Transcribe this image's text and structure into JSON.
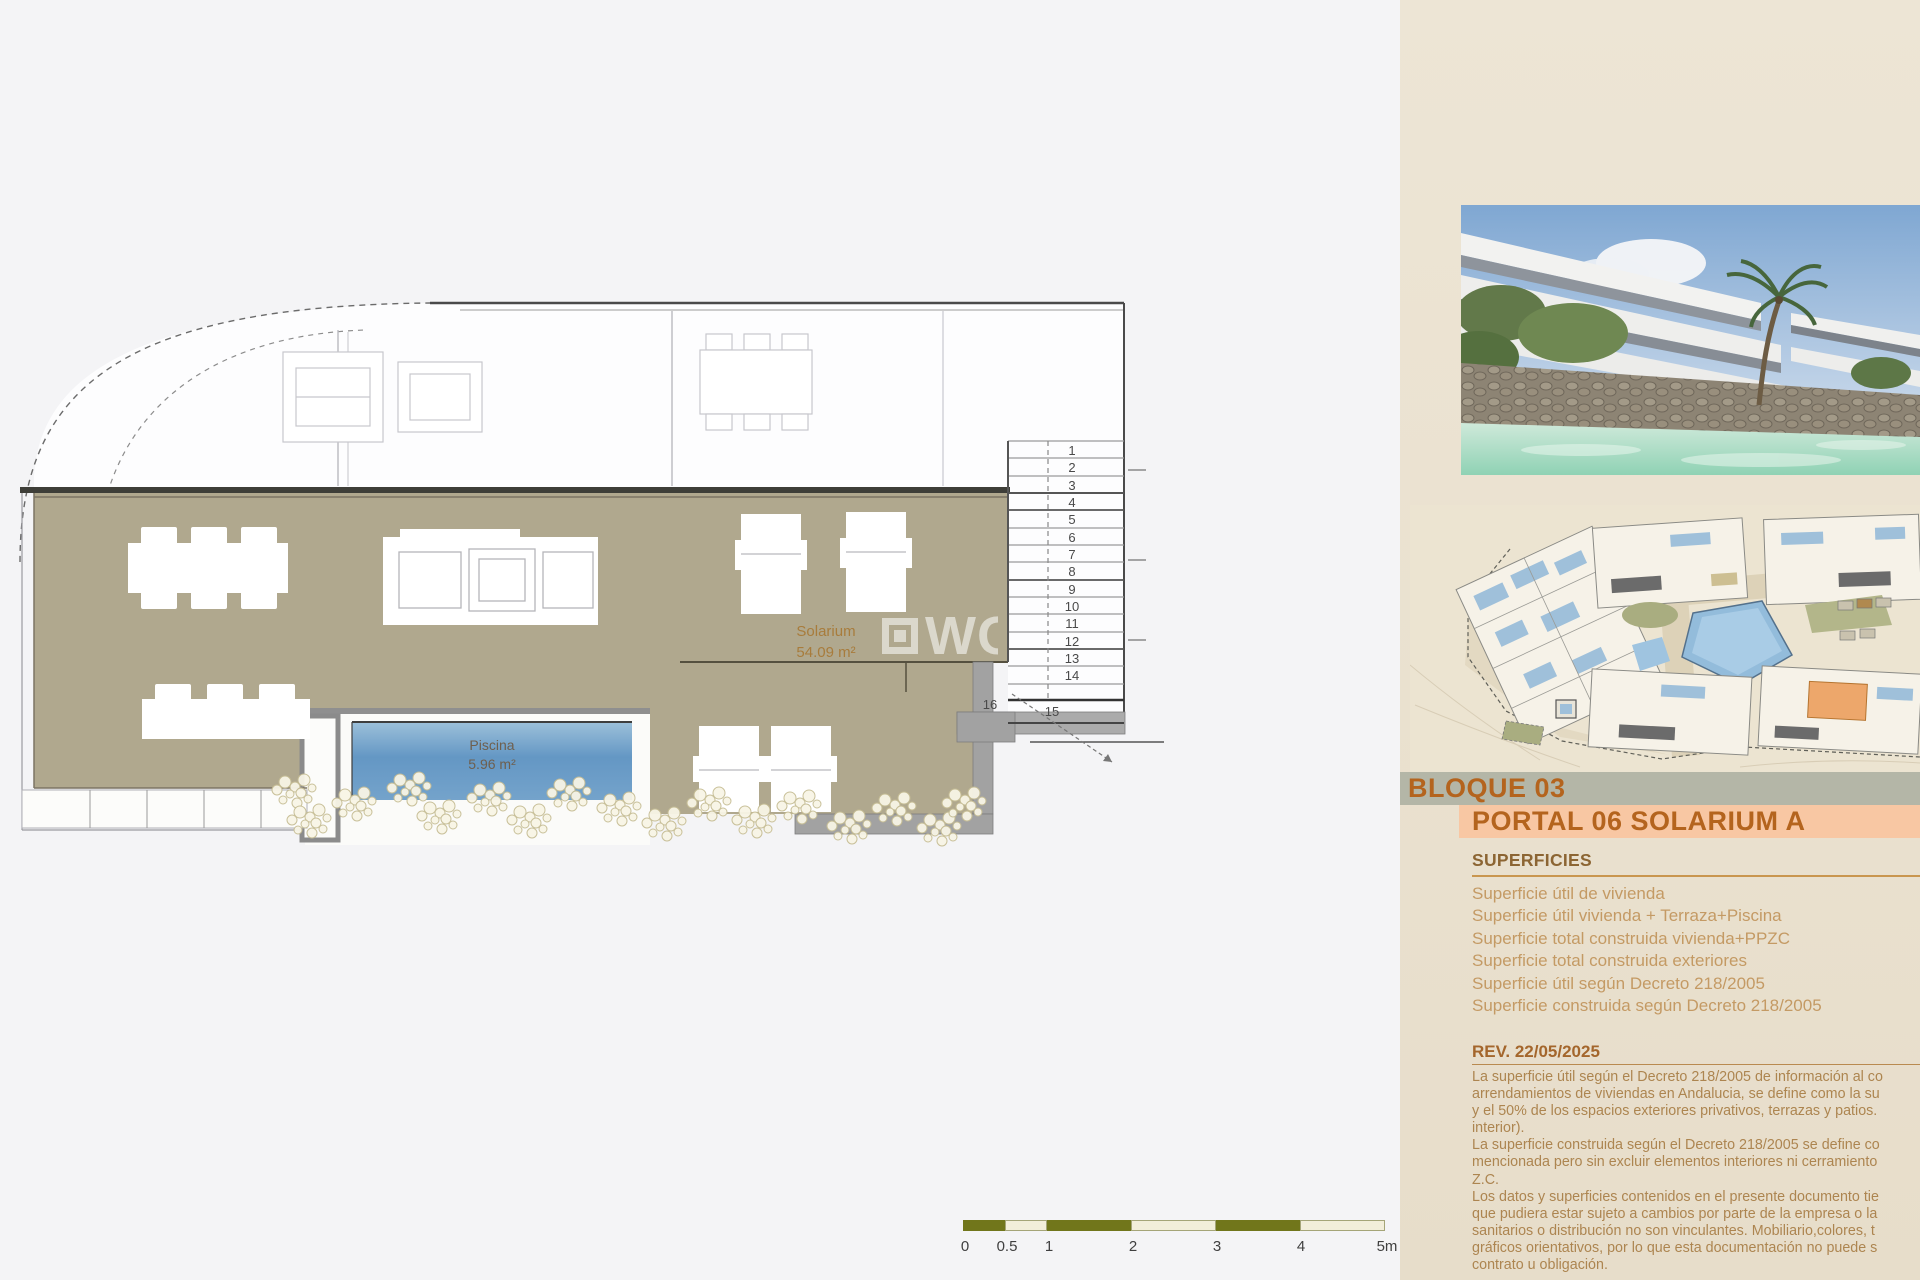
{
  "plan": {
    "solarium_label": "Solarium",
    "solarium_area": "54.09 m²",
    "pool_label": "Piscina",
    "pool_area": "5.96 m²",
    "stair_numbers": [
      "1",
      "2",
      "3",
      "4",
      "5",
      "6",
      "7",
      "8",
      "9",
      "10",
      "11",
      "12",
      "13",
      "14"
    ],
    "stair_15": "15",
    "stair_16": "16",
    "watermark": "WG"
  },
  "scalebar": {
    "labels": [
      "0",
      "0.5",
      "1",
      "2",
      "3",
      "4",
      "5m"
    ]
  },
  "panel": {
    "bloque_title": "BLOQUE 03",
    "portal_title": "PORTAL 06 SOLARIUM A",
    "superficies": {
      "heading": "SUPERFICIES",
      "items": [
        "Superficie útil de vivienda",
        "Superficie útil vivienda + Terraza+Piscina",
        "Superficie total construida vivienda+PPZC",
        "Superficie total construida exteriores",
        "Superficie útil según Decreto 218/2005",
        "Superficie construida según Decreto 218/2005"
      ]
    },
    "rev": {
      "heading": "REV. 22/05/2025",
      "lines": [
        "La superficie útil según el Decreto 218/2005 de información al co",
        "arrendamientos de viviendas en Andalucia, se define como la su",
        "y el 50% de los espacios exteriores privativos, terrazas y patios.",
        "interior).",
        "La superficie construida según el Decreto 218/2005 se define co",
        "mencionada pero sin excluir elementos interiores ni cerramiento",
        "Z.C.",
        "Los datos y superficies contenidos en el presente documento tie",
        "que pudiera estar sujeto a cambios por parte de la empresa o la",
        "sanitarios o distribución no son vinculantes. Mobiliario,colores, t",
        "gráficos orientativos, por lo que esta documentación no puede s",
        "contrato u obligación."
      ]
    }
  },
  "colors": {
    "accent_orange": "#b4641e",
    "band_gray": "#b4b6a7",
    "band_peach": "#f8c7a3",
    "deck_tan": "#b0a88e",
    "pool_blue": "#6d9fc9",
    "scale_olive": "#71761b"
  }
}
